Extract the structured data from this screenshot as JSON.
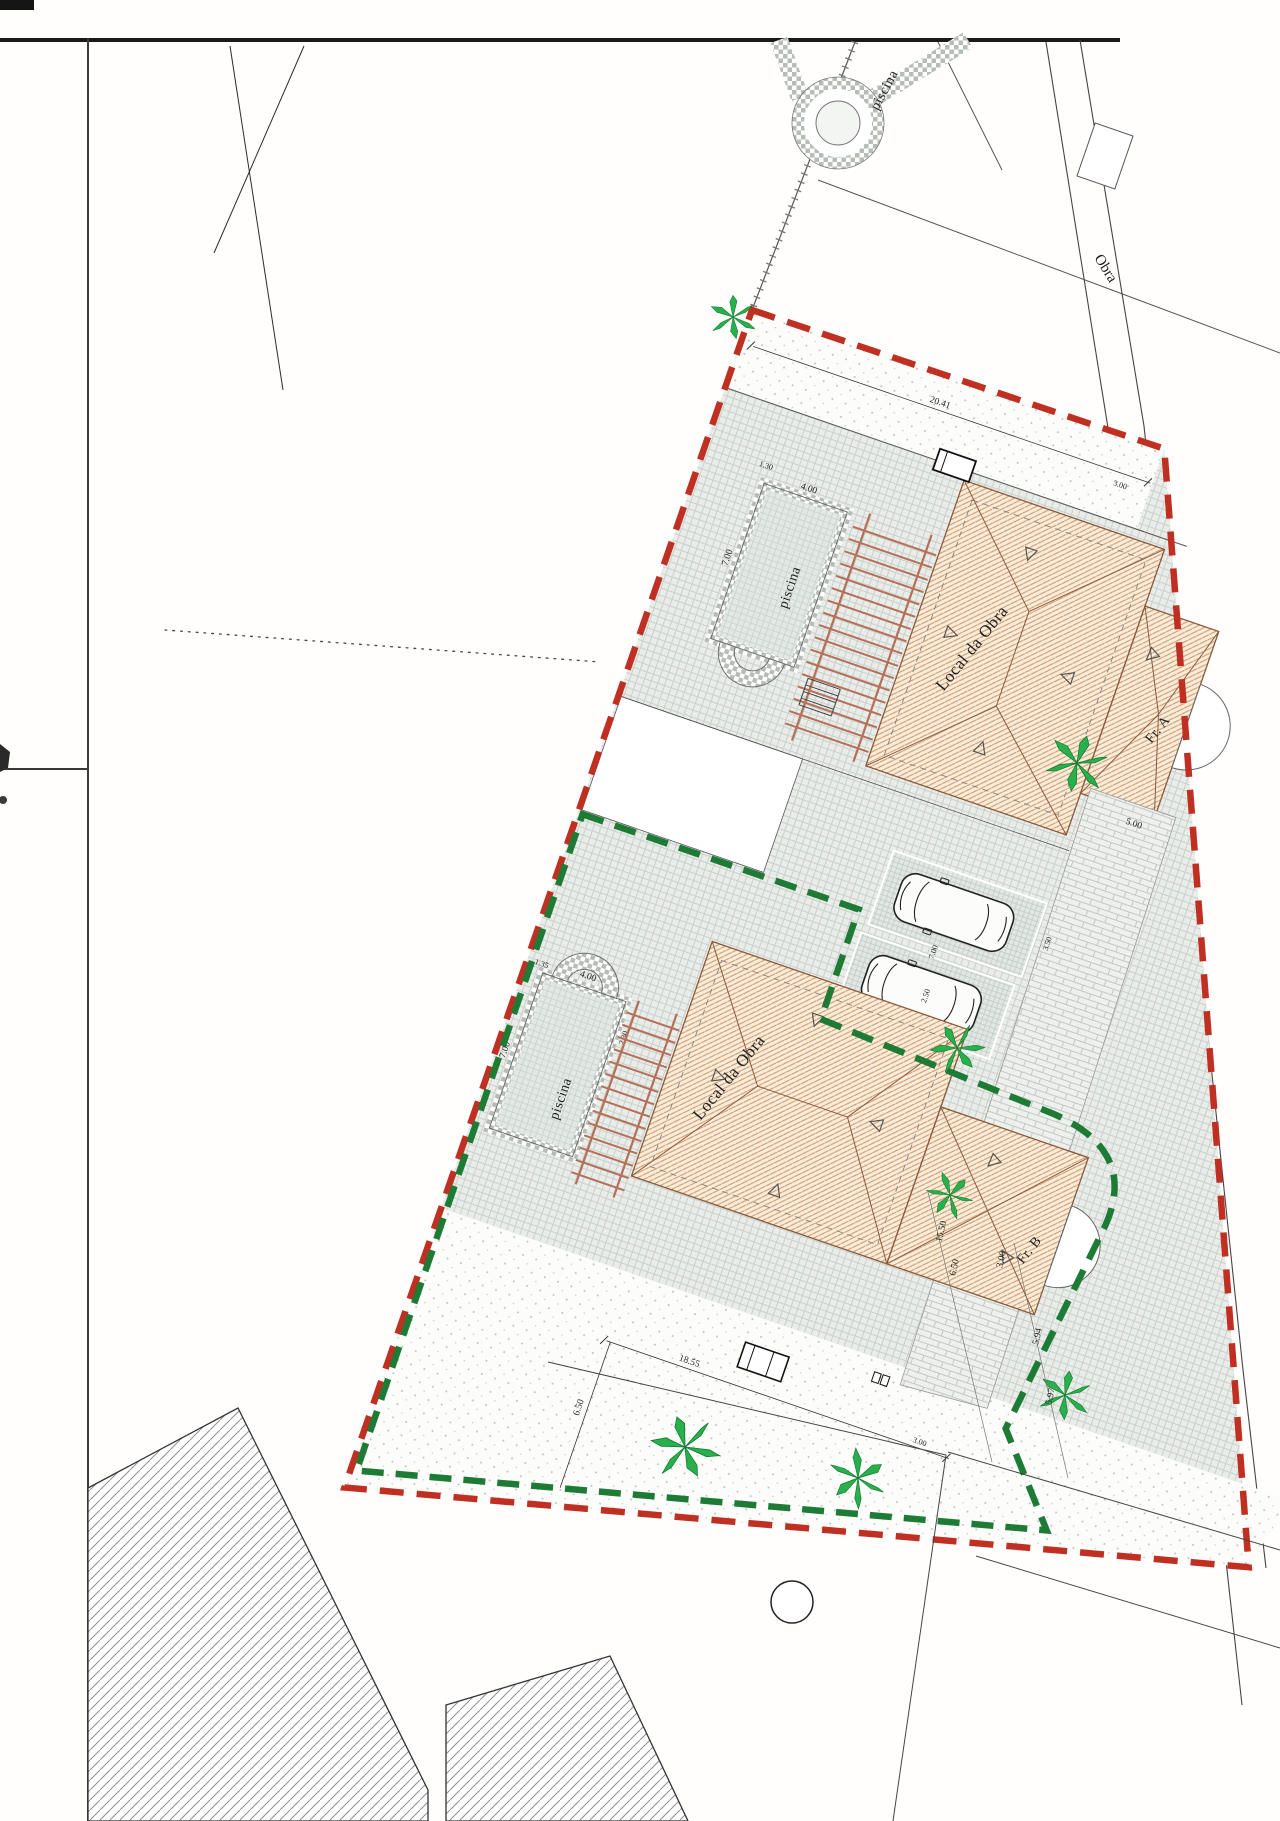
{
  "plan": {
    "labels": {
      "neighbor_pool": "piscina",
      "pool_a": "piscina",
      "pool_b": "piscina",
      "building_a": "Local da Obra",
      "building_b": "Local da Obra",
      "unit_a": "Fr. A",
      "unit_b": "Fr. B",
      "edge_text": "Obra"
    },
    "dimensions": {
      "front_width": "20.41",
      "front_side": "3.00",
      "pool_a_width": "4.00",
      "pool_a_length": "7.00",
      "pool_a_offset": "1.30",
      "pool_b_width": "4.00",
      "pool_b_length": "7.00",
      "pool_b_offset": "1.35",
      "pool_b_side": "2.30",
      "parking_width": "3.50",
      "parking_length": "7.00",
      "parking_half": "2.50",
      "drive_width": "5.00",
      "drive_depth": "7.00",
      "house_b_front": "18.55",
      "garden_depth": "6.50",
      "garden_side": "3.00",
      "street_1": "15.50",
      "street_2": "6.50",
      "street_3": "3.00",
      "street_4": "5.94",
      "street_5": "5.97"
    },
    "colors": {
      "boundary_outer": "#c03022",
      "boundary_inner": "#1e7b36",
      "roof_line": "#8a5a3c",
      "tree": "#29b04c"
    }
  }
}
